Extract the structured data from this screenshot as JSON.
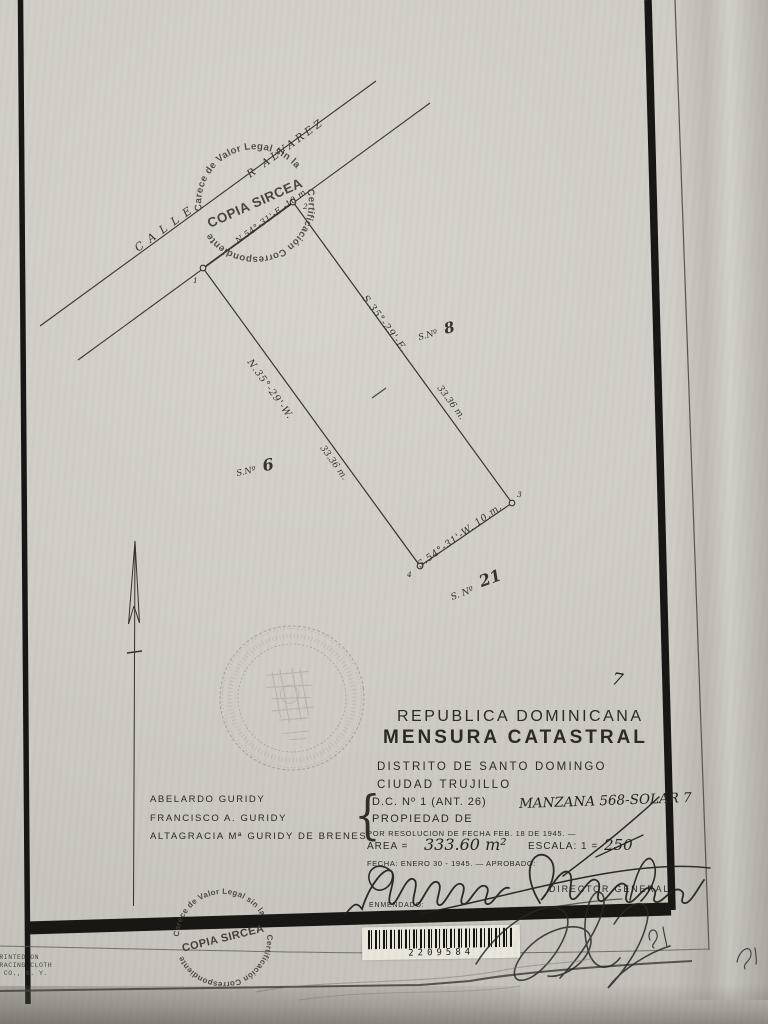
{
  "stamp": {
    "ring_top": "Carece de Valor Legal sin la",
    "ring_bottom": "Certificación Correspondiente",
    "center": "COPIA SIRCEA"
  },
  "street": {
    "calle": "CALLE",
    "name": "R ALVAREZ",
    "bearing": "N.54°-31'-E.-10.m."
  },
  "parcel": {
    "corners": [
      "1",
      "2",
      "3",
      "4"
    ],
    "right": {
      "bearing": "S.35°-29'-E.",
      "distance": "33.36 m.",
      "neighbor_prefix": "S.Nº",
      "neighbor_num": "8"
    },
    "left": {
      "bearing": "N.35°-29'-W.",
      "distance": "33.36 m.",
      "neighbor_prefix": "S.Nº",
      "neighbor_num": "6"
    },
    "bottom": {
      "bearing": "S.54°-31'-W. 10.m.",
      "neighbor_prefix": "S. Nº",
      "neighbor_num": "21"
    }
  },
  "header": {
    "country": "REPUBLICA DOMINICANA",
    "title": "MENSURA CATASTRAL",
    "district": "DISTRITO DE SANTO DOMINGO",
    "city": "CIUDAD TRUJILLO"
  },
  "details": {
    "brace": "{",
    "dc": "D.C. Nº 1 (ANT. 26)",
    "manzana": "MANZANA 568-SOLAR 7",
    "propiedad": "PROPIEDAD DE",
    "resolucion": "POR RESOLUCION DE FECHA FEB. 18 DE 1945. —",
    "area_label": "AREA =",
    "area_value": "333.60 m²",
    "escala_label": "ESCALA: 1 =",
    "escala_value": "250",
    "fecha": "FECHA: ENERO 30 - 1945. — APROBADO:",
    "enmendado": "ENMENDADO:",
    "director": "DIRECTOR GENERAL"
  },
  "owners": [
    "ABELARDO GURIDY",
    "FRANCISCO A. GURIDY",
    "ALTAGRACIA Mª GURIDY DE BRENES"
  ],
  "annotations": {
    "solar_number": "7"
  },
  "barcode": {
    "number": "2209584"
  },
  "footer_print": [
    "PRINTED ON",
    "TRACING CLOTH",
    "& CO., N. Y."
  ]
}
